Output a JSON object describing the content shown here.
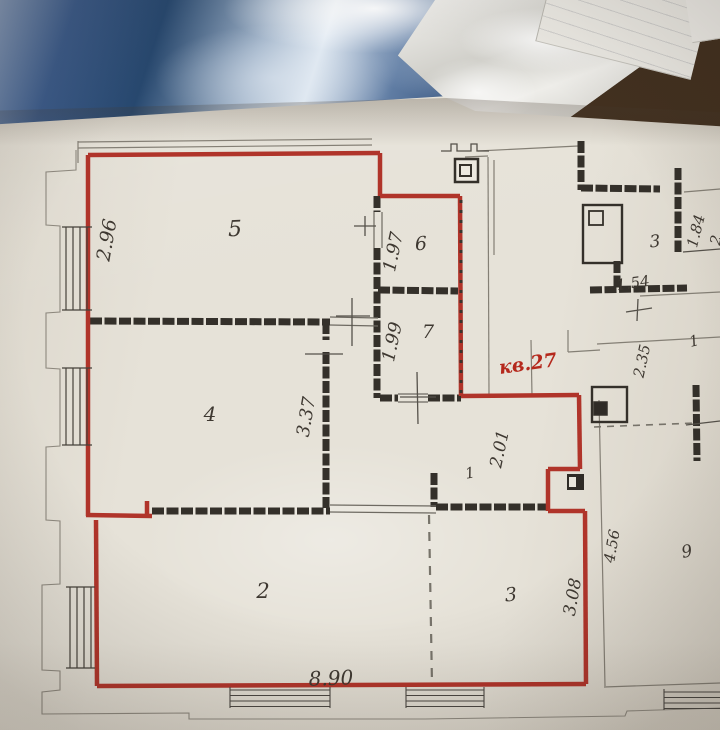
{
  "scene": {
    "background_objects": [
      "dark-table-surface",
      "blue-plastic-bag",
      "white-plastic-wrap",
      "tilted-paper-sheet"
    ]
  },
  "plan": {
    "colors": {
      "outline": "#b0342a",
      "stamp": "#b5281c",
      "walls": "#34302a",
      "paper": "#e6e2d8"
    },
    "stamp": {
      "text": "кв.27"
    },
    "rooms": [
      {
        "number": "5",
        "dimension": "2.96"
      },
      {
        "number": "6",
        "dimension": "1.97"
      },
      {
        "number": "7",
        "dimension": "1.99"
      },
      {
        "number": "4",
        "dimension": "3.37"
      },
      {
        "number": "1",
        "dimension": "2.01"
      },
      {
        "number": "2",
        "dimension": "8.90"
      },
      {
        "number": "3",
        "dimension": "3.08"
      }
    ],
    "neighbor": {
      "rooms": [
        {
          "number": "3"
        },
        {
          "number": "1"
        },
        {
          "number": "9"
        }
      ],
      "dimensions": [
        "1.84",
        "1.54",
        "2.35",
        "4.56"
      ],
      "partial_dimension": "2"
    }
  }
}
